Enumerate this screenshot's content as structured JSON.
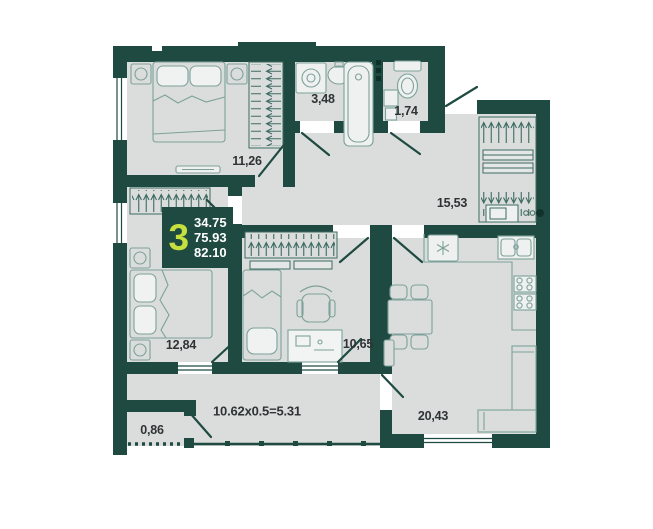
{
  "badge": {
    "rooms": "3",
    "values": [
      "34.75",
      "75.93",
      "82.10"
    ]
  },
  "rooms": [
    {
      "name": "bedroom-1",
      "area": "11,26"
    },
    {
      "name": "bathroom",
      "area": "3,48"
    },
    {
      "name": "wc",
      "area": "1,74"
    },
    {
      "name": "hallway",
      "area": "15,53"
    },
    {
      "name": "bedroom-2",
      "area": "12,84"
    },
    {
      "name": "kids-room",
      "area": "10,65"
    },
    {
      "name": "kitchen-living-room",
      "area": "20,43"
    },
    {
      "name": "storage",
      "area": "0,86"
    },
    {
      "name": "balcony",
      "area": "10.62x0.5=5.31"
    }
  ],
  "colors": {
    "wall": "#1E4A41",
    "floor": "#DADDDB",
    "furniture_line": "#7DA199",
    "hatch_line": "#3E6B62",
    "accent_lime": "#C4DF3E",
    "label_text": "#2E3335",
    "badge_text": "#FFFFFF"
  }
}
